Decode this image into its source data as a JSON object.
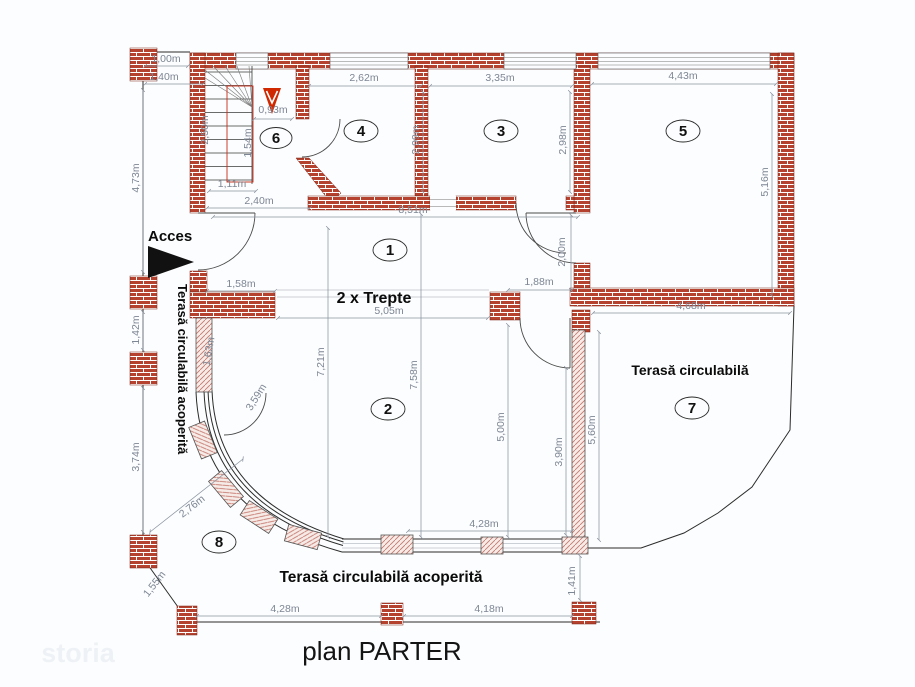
{
  "title": "plan PARTER",
  "watermark": "storia",
  "annotations": {
    "acces": "Acces",
    "trepte": "2 x Trepte",
    "terasa_left": "Terasă circulabilă acoperită",
    "terasa_right": "Terasă circulabilă",
    "terasa_bottom": "Terasă circulabilă acoperită"
  },
  "rooms": {
    "r1": "1",
    "r2": "2",
    "r3": "3",
    "r4": "4",
    "r5": "5",
    "r6": "6",
    "r7": "7",
    "r8": "8"
  },
  "dimensions": {
    "top_left_1": "1,00m",
    "top_left_2": "1,40m",
    "left_upper": "4,73m",
    "left_mid": "1,42m",
    "left_lower": "3,74m",
    "room4_w": "2,62m",
    "room3_w": "3,35m",
    "room5_w": "4,43m",
    "room4_h": "2,99m",
    "room3_h": "2,98m",
    "room5_h": "5,16m",
    "stair_w": "2,50m",
    "stair_top": "0,93m",
    "stair_mid": "1,54m",
    "stair_bottom": "1,11m",
    "hall_top": "2,40m",
    "hall_w": "8,51m",
    "porch_wall": "1,58m",
    "hall_door": "2,00m",
    "hall_gap": "1,88m",
    "steps_w": "5,05m",
    "terrace7_w": "4,68m",
    "room2_h1": "7,21m",
    "room2_h2": "7,58m",
    "room2_h3": "5,00m",
    "terrace7_h": "5,60m",
    "room2_right": "3,90m",
    "arc_1": "3,59m",
    "arc_2": "1,63m",
    "diag_1": "2,76m",
    "diag_2": "1,55m",
    "railing_w": "4,28m",
    "bottom_left": "4,28m",
    "bottom_mid": "4,18m",
    "bottom_right_v": "1,41m"
  },
  "colors": {
    "brick_red": "#b5422f",
    "accent_red": "#d02800",
    "dimension_gray": "#7d8694",
    "line_dark": "#2b2b2b",
    "column_hatch": "#c4756a"
  }
}
